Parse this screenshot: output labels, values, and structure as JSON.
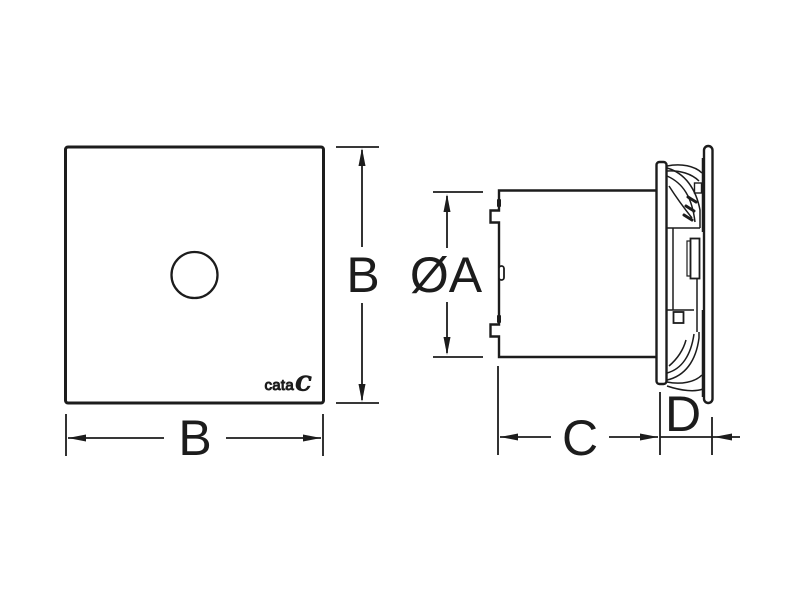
{
  "drawing": {
    "background_color": "#ffffff",
    "line_color": "#1c1c1c",
    "brand": {
      "logo_text": "cata",
      "logo_symbol": "C"
    },
    "front_view": {
      "height_dimension_label": "B",
      "width_dimension_label": "B"
    },
    "side_view": {
      "diameter_dimension_label": "ØA",
      "body_depth_dimension_label": "C",
      "front_panel_depth_dimension_label": "D"
    }
  }
}
